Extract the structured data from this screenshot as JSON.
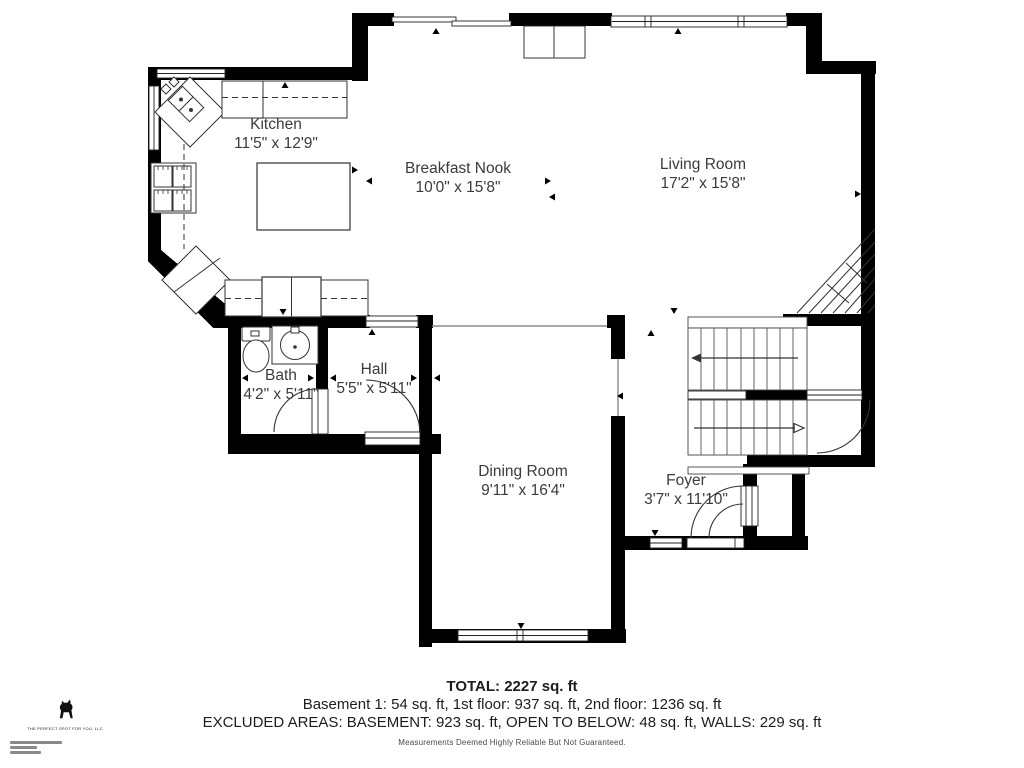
{
  "plan": {
    "rooms": [
      {
        "name": "Kitchen",
        "dims": "11'5\" x 12'9\""
      },
      {
        "name": "Breakfast Nook",
        "dims": "10'0\" x 15'8\""
      },
      {
        "name": "Living Room",
        "dims": "17'2\" x 15'8\""
      },
      {
        "name": "Bath",
        "dims": "4'2\" x 5'11\""
      },
      {
        "name": "Hall",
        "dims": "5'5\" x 5'11\""
      },
      {
        "name": "Dining Room",
        "dims": "9'11\" x 16'4\""
      },
      {
        "name": "Foyer",
        "dims": "3'7\" x 11'10\""
      }
    ]
  },
  "summary": {
    "total": "TOTAL: 2227 sq. ft",
    "floors": "Basement 1: 54 sq. ft, 1st floor: 937 sq. ft, 2nd floor: 1236 sq. ft",
    "excluded": "EXCLUDED AREAS: BASEMENT: 923 sq. ft, OPEN TO BELOW: 48 sq. ft, WALLS: 229 sq. ft",
    "disclaimer": "Measurements Deemed Highly Reliable But Not Guaranteed."
  },
  "branding": {
    "company": "THE PERFECT SPOT FOR YOU, LLC"
  },
  "colors": {
    "walls": "#000000",
    "thin_lines": "#333333",
    "label_text": "#3b3b3b"
  }
}
